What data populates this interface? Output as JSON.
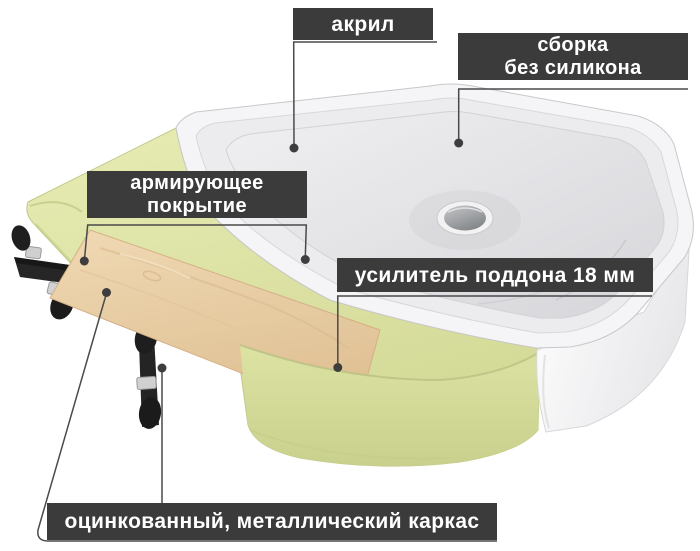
{
  "callouts": {
    "acrylic": {
      "label": "акрил"
    },
    "no_silicone_assembly": {
      "line1": "сборка",
      "line2": "без силикона"
    },
    "reinforcing_coating": {
      "line1": "армирующее",
      "line2": "покрытие"
    },
    "tray_stiffener": {
      "label": "усилитель поддона 18 мм"
    },
    "galvanized_frame": {
      "label": "оцинкованный, металлический каркас"
    }
  },
  "colors": {
    "label_bg": "#3b3b3b",
    "label_text": "#ffffff",
    "leader": "#4a4a4a",
    "coating_yellow": "#dde3a5",
    "wood": "#e9cfa6",
    "acrylic_white": "#f5f5f7",
    "frame_black": "#262626",
    "background": "#ffffff"
  },
  "illustration_parts": [
    "acrylic-tray-top",
    "reinforcing-coating-layer",
    "plywood-stiffener-strip",
    "front-apron",
    "white-side-panel",
    "galvanized-metal-frame-with-adjustable-feet",
    "chrome-drain"
  ]
}
